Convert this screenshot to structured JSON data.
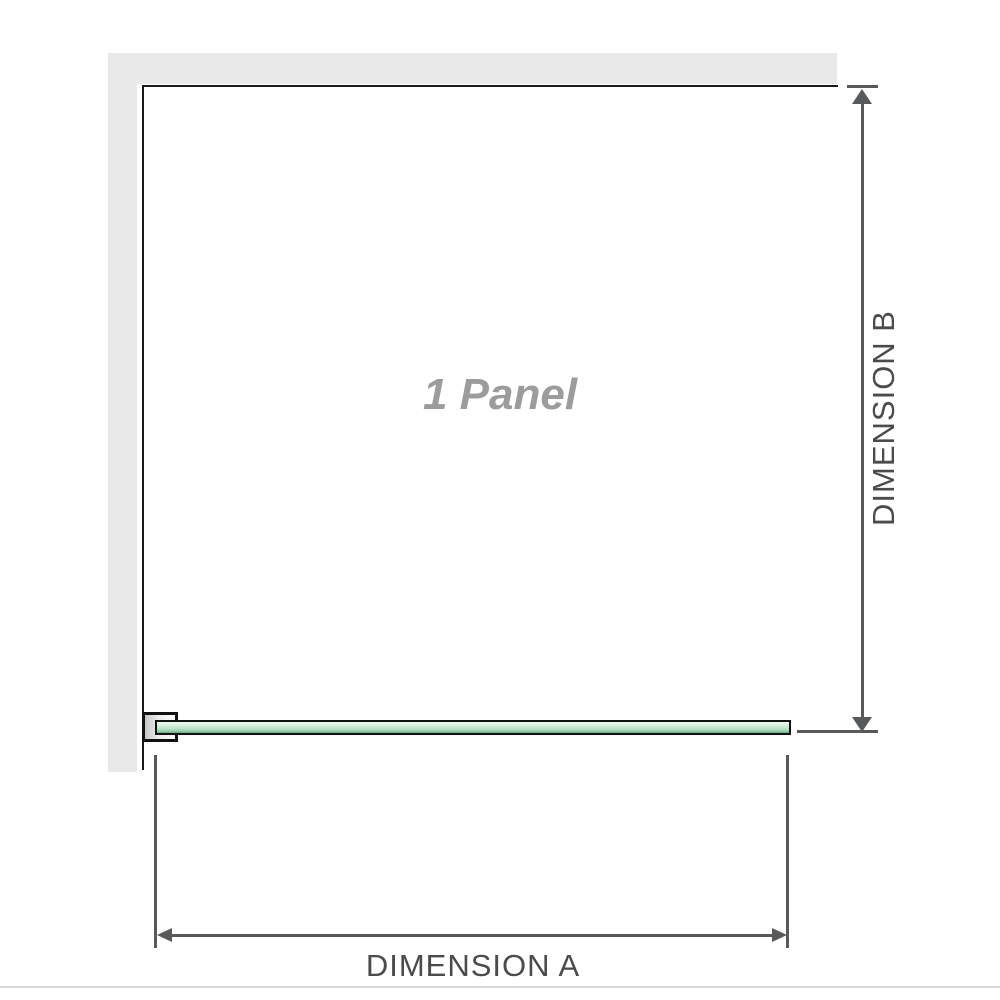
{
  "diagram": {
    "panel_label": "1 Panel",
    "dimension_a_label": "DIMENSION A",
    "dimension_b_label": "DIMENSION B"
  },
  "colors": {
    "background": "#ffffff",
    "wall_fill": "#e9e9e9",
    "wall_edge": "#1a1a1a",
    "glass_border": "#111111",
    "glass_green_light": "#f2faf4",
    "glass_green_mid": "#c2e6cf",
    "glass_green_dark": "#68a886",
    "bracket_fill": "#c6c6c6",
    "dimension_line": "#58595b",
    "dimension_text": "#4b4b4d",
    "panel_label_text": "#9c9c9c",
    "separator_line": "#d9d9d9"
  }
}
